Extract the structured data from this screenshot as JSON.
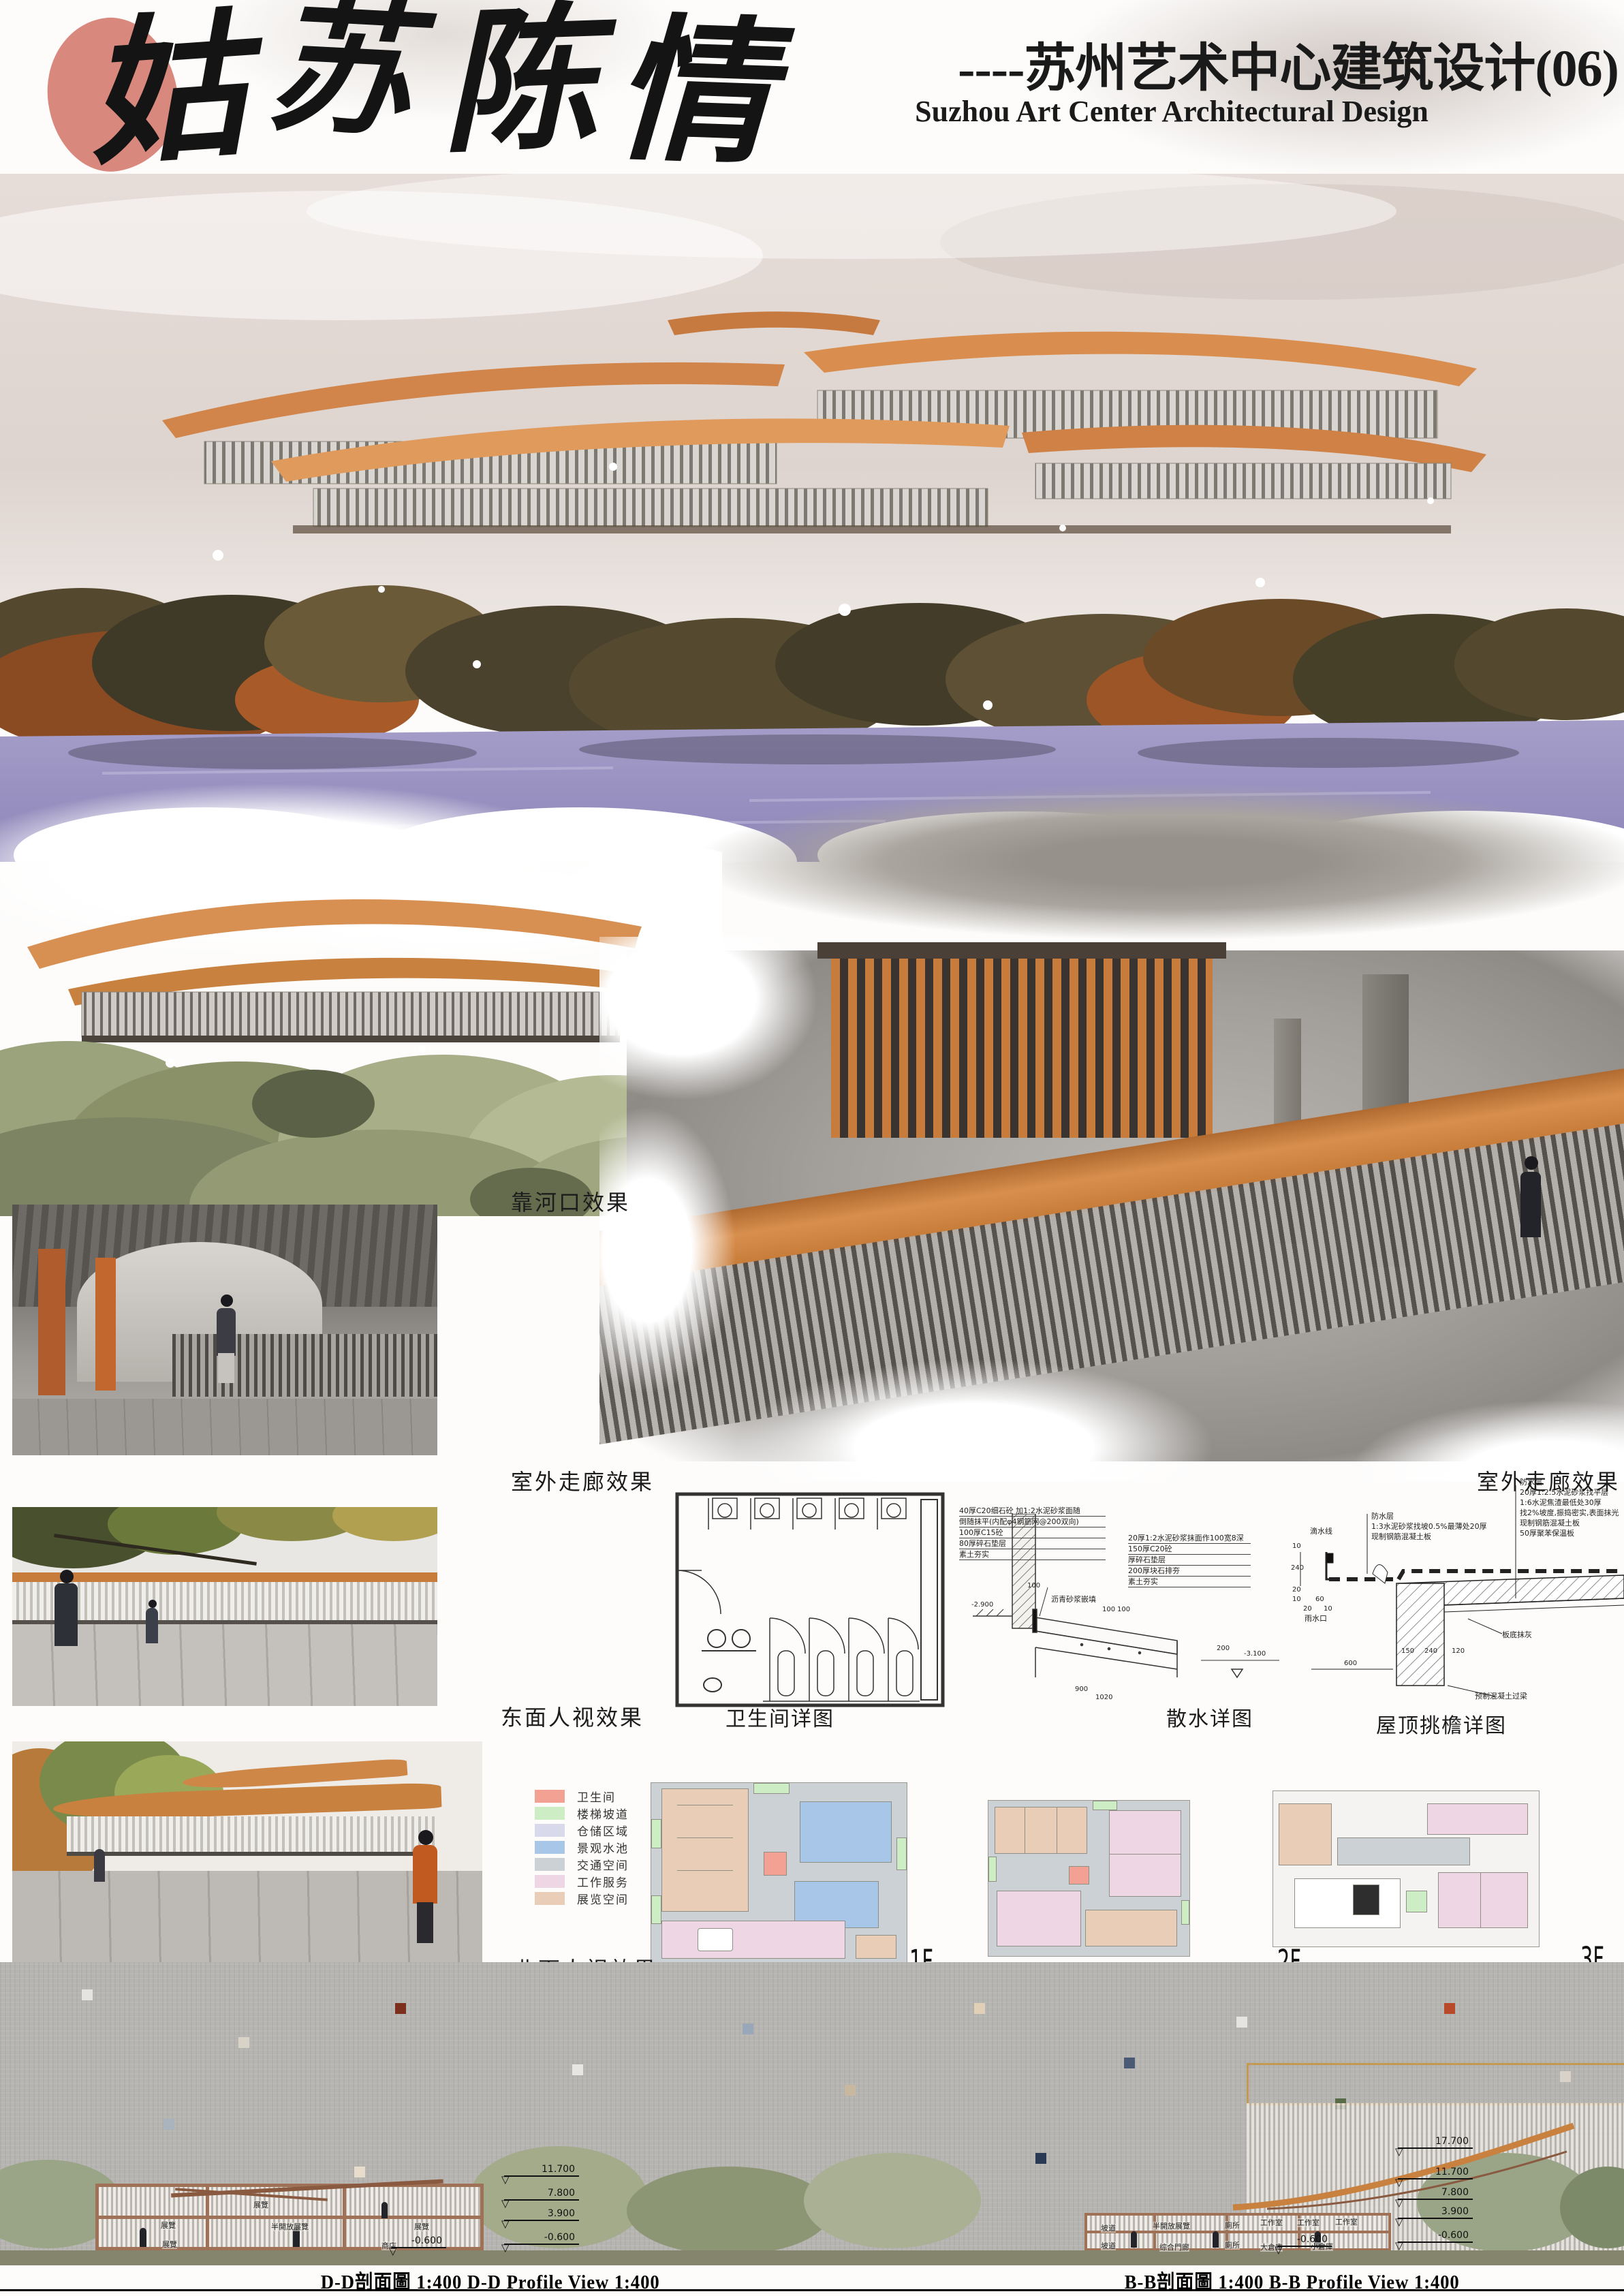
{
  "header": {
    "calligraphy_title": "姑苏陈情",
    "calligraphy_chars": [
      "姑",
      "苏",
      "陈",
      "情"
    ],
    "subtitle_cn": "----苏州艺术中心建筑设计(06)",
    "subtitle_en": "Suzhou Art Center Architectural Design"
  },
  "labels": {
    "river_mouth": "靠河口效果",
    "outdoor_corridor_left": "室外走廊效果",
    "outdoor_corridor_right": "室外走廊效果",
    "east_view": "东面人视效果",
    "north_view": "北面人视效果"
  },
  "drawings": {
    "toilet_caption": "卫生间详图",
    "apron_caption": "散水详图",
    "eave_caption": "屋顶挑檐详图",
    "apron_left_notes": [
      "40厚C20细石砼 加1:2水泥砂浆面随",
      "倒随抹平(内配φ4钢筋网@200双向)",
      "100厚C15砼",
      "80厚碎石垫层",
      "素土夯实"
    ],
    "apron_right_notes": [
      "20厚1:2水泥砂浆抹面作100宽8深",
      "150厚C20砼",
      "厚碎石垫层",
      "200厚块石排夯",
      "素土夯实"
    ],
    "apron_bitumen": "沥青砂浆嵌填",
    "apron_elev_left": "-2.900",
    "apron_elev_right": "-3.100",
    "apron_dims": [
      "100",
      "100",
      "100",
      "200",
      "900",
      "1020"
    ],
    "eave_mid_notes": [
      "防水层",
      "1:3水泥砂浆找坡0.5%最薄处20厚",
      "现制钢筋混凝土板"
    ],
    "eave_right_notes": [
      "防水层",
      "20厚1:2.5水泥砂浆找平层",
      "1:6水泥焦渣最低处30厚",
      "找2%坡度,振捣密实,表面抹光",
      "现制钢筋混凝土板",
      "50厚聚苯保温板"
    ],
    "eave_drip": "滴水线",
    "eave_gutter": "雨水口",
    "eave_soffit": "板底抹灰",
    "eave_lintel": "预制混凝土过梁",
    "eave_dims": [
      "10",
      "240",
      "20",
      "10",
      "60",
      "20",
      "10",
      "600",
      "150",
      "240",
      "120"
    ]
  },
  "legend": {
    "items": [
      {
        "label": "卫生间",
        "color": "#f2a193"
      },
      {
        "label": "楼梯坡道",
        "color": "#cdeec4"
      },
      {
        "label": "仓储区域",
        "color": "#d9d9ec"
      },
      {
        "label": "景观水池",
        "color": "#a7c6e8"
      },
      {
        "label": "交通空间",
        "color": "#ccd1d5"
      },
      {
        "label": "工作服务",
        "color": "#eed6e4"
      },
      {
        "label": "展览空间",
        "color": "#e9cdb6"
      }
    ]
  },
  "floor_plans": {
    "f1": "1F",
    "f2": "2F",
    "f3": "3F"
  },
  "sections": {
    "dd": {
      "caption": "D-D剖面圖 1:400 D-D Profile View 1:400",
      "rooms": [
        "展覽",
        "展覽",
        "半開放展覽",
        "展覽",
        "展覽",
        "商店"
      ],
      "elevations": [
        "11.700",
        "7.800",
        "3.900",
        "-0.600"
      ],
      "base_elev": "-0.600"
    },
    "bb": {
      "caption": "B-B剖面圖 1:400 B-B Profile View 1:400",
      "rooms": [
        "坡道",
        "半開放展覽",
        "廁所",
        "工作室",
        "工作室",
        "工作室",
        "坡道",
        "综合門廊",
        "廁所",
        "大倉庫",
        "小倉庫"
      ],
      "elevations": [
        "17.700",
        "11.700",
        "7.800",
        "3.900",
        "-0.600"
      ],
      "base_elev": "-0.600"
    }
  }
}
